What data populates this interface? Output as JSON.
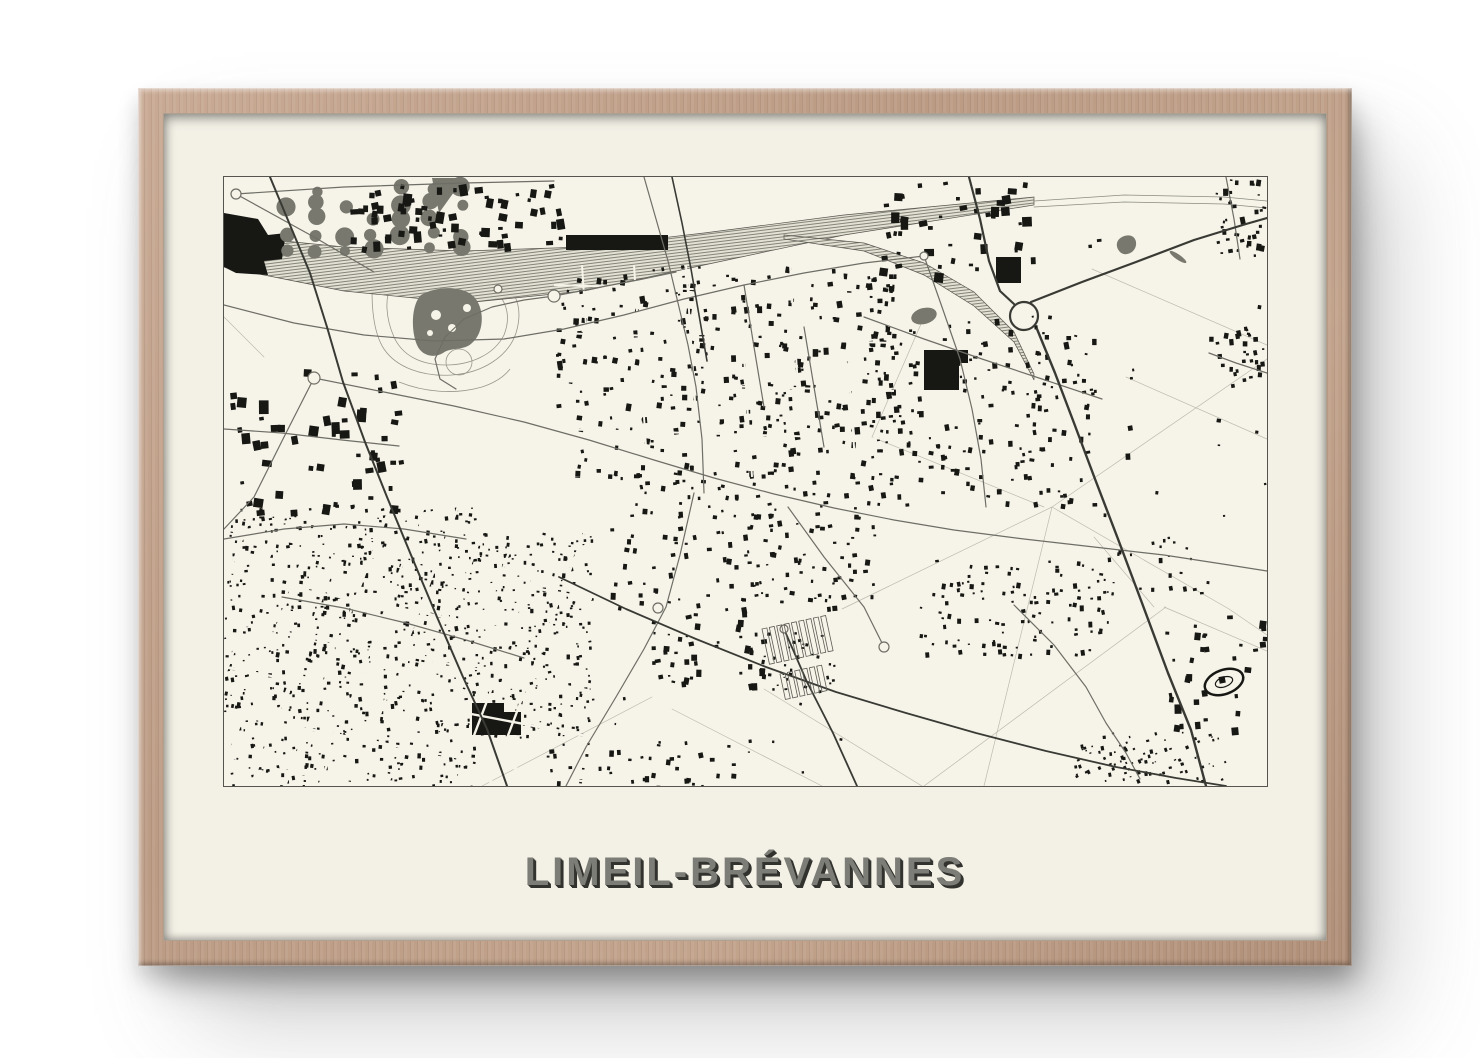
{
  "poster": {
    "title": "LIMEIL-BRÉVANNES"
  },
  "colors": {
    "page_bg": "#ffffff",
    "frame_wood": "#bb9b84",
    "mat": "#f3f1e6",
    "map_paper": "#f6f4e9",
    "map_border": "#55544e",
    "ink": "#171714",
    "gray_fill": "#78786f",
    "road": "#6e6e66",
    "road_dark": "#3a3a35",
    "faint_line": "#bcbaae",
    "outline": "#97968c",
    "title_face": "#7d7d77",
    "title_shadow": "#32322e"
  },
  "map": {
    "width": 1043,
    "height": 609,
    "orchard": {
      "x0": 62,
      "y0": 12,
      "cols": 7,
      "rows": 5,
      "dx": 29,
      "dy": 15,
      "jitter": 3,
      "rmin": 5,
      "rmax": 10,
      "skip": 0.18
    },
    "railways": [
      {
        "pts": [
          [
            0,
            74
          ],
          [
            120,
            92
          ],
          [
            240,
            100
          ],
          [
            360,
            92
          ],
          [
            480,
            72
          ],
          [
            620,
            48
          ],
          [
            810,
            24
          ]
        ],
        "half": [
          16,
          22,
          26,
          22,
          16,
          10,
          4
        ]
      },
      {
        "pts": [
          [
            560,
            60
          ],
          [
            640,
            70
          ],
          [
            700,
            92
          ],
          [
            750,
            122
          ],
          [
            790,
            160
          ],
          [
            810,
            200
          ]
        ],
        "half": [
          2,
          4,
          6,
          7,
          5,
          3
        ]
      }
    ],
    "rail_lines": [
      [
        [
          810,
          24
        ],
        [
          900,
          18
        ],
        [
          1000,
          20
        ],
        [
          1043,
          24
        ]
      ],
      [
        [
          810,
          30
        ],
        [
          900,
          25
        ],
        [
          1000,
          27
        ],
        [
          1043,
          31
        ]
      ]
    ],
    "outline_paths": [
      "M150,95 C180,88 230,86 262,96 C292,106 300,130 292,156 C284,180 258,196 228,198 C198,200 172,190 160,172 C148,154 146,118 150,95",
      "M168,108 C192,100 238,98 262,108 C282,118 288,138 280,158 C270,178 246,188 222,188 C196,188 178,178 170,160 C162,142 160,120 168,108",
      "M175,205 C200,215 230,218 258,210 C270,206 280,200 286,192"
    ],
    "outline_circles": [
      [
        235,
        185,
        13
      ]
    ],
    "gray_paths": [
      "M197,118 c18,-10 44,-9 54,3 c10,12 9,35 -3,45 c-8,8 -21,4 -29,10 c-10,6 -22,2 -26,-8 c-6,-14 -6,-40 4,-50 z",
      "M208,1 L240,1 L215,36 Z",
      "M898,60 c8,-4 15,0 14,8 c-1,8 -11,12 -16,7 c-5,-5 -4,-12 2,-15 z"
    ],
    "gray_ellipses": [
      {
        "cx": 700,
        "cy": 139,
        "rx": 13,
        "ry": 8,
        "rot": -15
      },
      {
        "cx": 954,
        "cy": 80,
        "rx": 10,
        "ry": 2.6,
        "rot": 35
      }
    ],
    "lake_holes": [
      [
        212,
        138,
        5
      ],
      [
        228,
        151,
        4
      ],
      [
        243,
        131,
        4
      ],
      [
        206,
        156,
        3
      ]
    ],
    "black_paths": [
      "M0,36 L34,42 L44,58 L62,56 L58,82 L40,84 L44,98 L12,96 L0,90 Z",
      "M342,58 h102 v15 h-102 z",
      "M700,173 h44 v13 h-9 v27 h-35 z",
      "M248,526 h32 v9 h17 v23 h-49 z",
      "M772,80 h25 v26 h-25 z"
    ],
    "clusters": [
      {
        "x": 125,
        "y": 6,
        "w": 210,
        "h": 64,
        "n": 70,
        "s0": 3,
        "s1": 9
      },
      {
        "x": 655,
        "y": 4,
        "w": 155,
        "h": 98,
        "n": 48,
        "s0": 3,
        "s1": 10
      },
      {
        "x": 990,
        "y": 2,
        "w": 50,
        "h": 80,
        "n": 36,
        "s0": 2,
        "s1": 5
      },
      {
        "x": 330,
        "y": 88,
        "w": 340,
        "h": 210,
        "n": 330,
        "s0": 2,
        "s1": 5.5
      },
      {
        "x": 645,
        "y": 138,
        "w": 225,
        "h": 190,
        "n": 190,
        "s0": 2,
        "s1": 5
      },
      {
        "x": 985,
        "y": 148,
        "w": 56,
        "h": 62,
        "n": 30,
        "s0": 2,
        "s1": 5
      },
      {
        "x": 0,
        "y": 192,
        "w": 175,
        "h": 142,
        "n": 55,
        "s0": 3.5,
        "s1": 10
      },
      {
        "x": 380,
        "y": 298,
        "w": 270,
        "h": 132,
        "n": 165,
        "s0": 2,
        "s1": 5
      },
      {
        "x": 695,
        "y": 383,
        "w": 195,
        "h": 96,
        "n": 115,
        "s0": 1.8,
        "s1": 4.2
      },
      {
        "x": 0,
        "y": 330,
        "w": 250,
        "h": 279,
        "n": 640,
        "s0": 1.4,
        "s1": 3.6
      },
      {
        "x": 250,
        "y": 355,
        "w": 118,
        "h": 205,
        "n": 255,
        "s0": 1.4,
        "s1": 3.4
      },
      {
        "x": 420,
        "y": 430,
        "w": 120,
        "h": 78,
        "n": 48,
        "s0": 2,
        "s1": 6
      },
      {
        "x": 540,
        "y": 452,
        "w": 72,
        "h": 62,
        "n": 30,
        "s0": 1.6,
        "s1": 3.5
      },
      {
        "x": 940,
        "y": 428,
        "w": 100,
        "h": 128,
        "n": 34,
        "s0": 2.5,
        "s1": 7
      },
      {
        "x": 848,
        "y": 552,
        "w": 152,
        "h": 52,
        "n": 92,
        "s0": 1.4,
        "s1": 3.2,
        "rot": -18
      },
      {
        "x": 850,
        "y": 60,
        "w": 190,
        "h": 300,
        "n": 16,
        "s0": 2,
        "s1": 5
      },
      {
        "x": 320,
        "y": 560,
        "w": 200,
        "h": 49,
        "n": 40,
        "s0": 2,
        "s1": 5
      },
      {
        "x": 870,
        "y": 360,
        "w": 120,
        "h": 60,
        "n": 25,
        "s0": 1.8,
        "s1": 4
      },
      {
        "x": 350,
        "y": 520,
        "w": 300,
        "h": 80,
        "n": 10,
        "s0": 1.5,
        "s1": 3.5
      }
    ],
    "carves": [
      {
        "clip": [
          0,
          330,
          368,
          279
        ],
        "lines": [
          {
            "from": [
              30,
              330
            ],
            "to": [
              -75,
              609
            ],
            "repeat": 11,
            "step": [
              34,
              0
            ]
          },
          {
            "from": [
              0,
              352
            ],
            "to": [
              368,
              422
            ],
            "repeat": 6,
            "step": [
              0,
              46
            ]
          }
        ],
        "width": 2.4
      },
      {
        "clip": [
          330,
          88,
          340,
          212
        ],
        "lines": [
          {
            "from": [
              358,
              88
            ],
            "to": [
              372,
              300
            ],
            "repeat": 7,
            "step": [
              52,
              0
            ]
          },
          {
            "from": [
              330,
              108
            ],
            "to": [
              670,
              118
            ],
            "repeat": 5,
            "step": [
              0,
              48
            ]
          }
        ],
        "width": 2
      }
    ],
    "faint_lines": [
      [
        [
          828,
          330
        ],
        [
          1043,
          182
        ]
      ],
      [
        [
          828,
          330
        ],
        [
          1005,
          432
        ]
      ],
      [
        [
          700,
          609
        ],
        [
          942,
          430
        ]
      ],
      [
        [
          868,
          92
        ],
        [
          1043,
          168
        ]
      ],
      [
        [
          902,
          200
        ],
        [
          1043,
          262
        ]
      ],
      [
        [
          828,
          330
        ],
        [
          760,
          609
        ]
      ],
      [
        [
          618,
          432
        ],
        [
          828,
          330
        ]
      ],
      [
        [
          940,
          430
        ],
        [
          1043,
          474
        ]
      ],
      [
        [
          540,
          512
        ],
        [
          698,
          609
        ]
      ],
      [
        [
          448,
          532
        ],
        [
          598,
          609
        ]
      ],
      [
        [
          258,
          609
        ],
        [
          428,
          520
        ]
      ],
      [
        [
          820,
          330
        ],
        [
          648,
          260
        ]
      ],
      [
        [
          648,
          260
        ],
        [
          700,
          140
        ]
      ],
      [
        [
          870,
          360
        ],
        [
          930,
          430
        ]
      ],
      [
        [
          1005,
          432
        ],
        [
          1043,
          458
        ]
      ],
      [
        [
          0,
          140
        ],
        [
          40,
          180
        ]
      ]
    ],
    "roads": [
      [
        [
          0,
          128
        ],
        [
          70,
          146
        ],
        [
          140,
          158
        ],
        [
          210,
          164
        ],
        [
          280,
          162
        ],
        [
          340,
          152
        ],
        [
          400,
          138
        ],
        [
          460,
          122
        ],
        [
          520,
          108
        ],
        [
          580,
          96
        ],
        [
          640,
          86
        ],
        [
          700,
          79
        ]
      ],
      [
        [
          420,
          0
        ],
        [
          432,
          42
        ],
        [
          444,
          84
        ],
        [
          454,
          126
        ],
        [
          464,
          168
        ],
        [
          472,
          210
        ],
        [
          478,
          262
        ],
        [
          480,
          316
        ]
      ],
      [
        [
          90,
          201
        ],
        [
          160,
          215
        ],
        [
          230,
          229
        ],
        [
          300,
          245
        ],
        [
          365,
          263
        ],
        [
          430,
          283
        ],
        [
          490,
          301
        ],
        [
          550,
          317
        ],
        [
          610,
          331
        ],
        [
          670,
          343
        ],
        [
          730,
          353
        ],
        [
          800,
          362
        ],
        [
          870,
          370
        ],
        [
          940,
          378
        ],
        [
          1005,
          388
        ],
        [
          1043,
          394
        ]
      ],
      [
        [
          470,
          316
        ],
        [
          456,
          378
        ],
        [
          442,
          430
        ],
        [
          420,
          472
        ],
        [
          392,
          520
        ],
        [
          362,
          570
        ],
        [
          342,
          609
        ]
      ],
      [
        [
          640,
          140
        ],
        [
          700,
          162
        ],
        [
          758,
          182
        ],
        [
          818,
          202
        ],
        [
          878,
          222
        ]
      ],
      [
        [
          700,
          79
        ],
        [
          718,
          130
        ],
        [
          736,
          182
        ],
        [
          748,
          232
        ],
        [
          757,
          282
        ],
        [
          762,
          330
        ]
      ],
      [
        [
          0,
          252
        ],
        [
          58,
          256
        ],
        [
          118,
          263
        ],
        [
          175,
          269
        ]
      ],
      [
        [
          0,
          362
        ],
        [
          60,
          352
        ],
        [
          120,
          347
        ],
        [
          180,
          352
        ],
        [
          242,
          362
        ]
      ],
      [
        [
          58,
          420
        ],
        [
          120,
          431
        ],
        [
          182,
          446
        ],
        [
          242,
          463
        ],
        [
          300,
          481
        ]
      ],
      [
        [
          330,
          119
        ],
        [
          300,
          123
        ],
        [
          268,
          130
        ],
        [
          240,
          142
        ],
        [
          221,
          160
        ],
        [
          211,
          182
        ],
        [
          216,
          202
        ],
        [
          232,
          212
        ]
      ],
      [
        [
          330,
          119
        ],
        [
          372,
          111
        ],
        [
          414,
          103
        ],
        [
          452,
          95
        ]
      ],
      [
        [
          985,
          176
        ],
        [
          1012,
          186
        ],
        [
          1043,
          196
        ]
      ],
      [
        [
          1002,
          0
        ],
        [
          1010,
          42
        ],
        [
          1016,
          82
        ]
      ],
      [
        [
          790,
          428
        ],
        [
          830,
          468
        ],
        [
          862,
          510
        ],
        [
          882,
          546
        ],
        [
          902,
          576
        ],
        [
          916,
          602
        ]
      ],
      [
        [
          12,
          17
        ],
        [
          90,
          60
        ],
        [
          150,
          95
        ]
      ],
      [
        [
          12,
          17
        ],
        [
          120,
          10
        ],
        [
          240,
          6
        ],
        [
          330,
          4
        ]
      ],
      [
        [
          90,
          201
        ],
        [
          60,
          260
        ],
        [
          30,
          320
        ],
        [
          0,
          352
        ]
      ],
      [
        [
          564,
          330
        ],
        [
          600,
          380
        ],
        [
          640,
          430
        ],
        [
          660,
          470
        ]
      ],
      [
        [
          520,
          108
        ],
        [
          530,
          170
        ],
        [
          540,
          230
        ]
      ],
      [
        [
          580,
          150
        ],
        [
          590,
          210
        ],
        [
          600,
          270
        ]
      ]
    ],
    "dark_roads": [
      {
        "pts": [
          [
            745,
            0
          ],
          [
            756,
            42
          ],
          [
            765,
            84
          ],
          [
            776,
            114
          ],
          [
            790,
            127
          ]
        ],
        "w": 2.2
      },
      {
        "pts": [
          [
            813,
            152
          ],
          [
            831,
            196
          ],
          [
            850,
            246
          ],
          [
            871,
            302
          ],
          [
            894,
            362
          ],
          [
            918,
            426
          ],
          [
            944,
            496
          ],
          [
            967,
            553
          ],
          [
            982,
            609
          ]
        ],
        "w": 2.4
      },
      {
        "pts": [
          [
            807,
            125
          ],
          [
            858,
            105
          ],
          [
            912,
            85
          ],
          [
            970,
            63
          ],
          [
            1022,
            47
          ],
          [
            1043,
            41
          ]
        ],
        "w": 2.2
      },
      {
        "pts": [
          [
            46,
            0
          ],
          [
            66,
            48
          ],
          [
            86,
            96
          ],
          [
            103,
            150
          ],
          [
            119,
            205
          ],
          [
            141,
            265
          ],
          [
            163,
            320
          ],
          [
            187,
            378
          ],
          [
            213,
            440
          ],
          [
            239,
            500
          ],
          [
            263,
            552
          ],
          [
            283,
            609
          ]
        ],
        "w": 2
      },
      {
        "pts": [
          [
            335,
            400
          ],
          [
            402,
            432
          ],
          [
            472,
            462
          ],
          [
            542,
            490
          ],
          [
            612,
            515
          ],
          [
            682,
            536
          ],
          [
            752,
            556
          ],
          [
            822,
            574
          ],
          [
            892,
            590
          ],
          [
            952,
            601
          ],
          [
            1002,
            609
          ]
        ],
        "w": 1.8
      },
      {
        "pts": [
          [
            560,
            452
          ],
          [
            583,
            505
          ],
          [
            609,
            556
          ],
          [
            633,
            609
          ]
        ],
        "w": 1.8
      },
      {
        "pts": [
          [
            448,
            0
          ],
          [
            458,
            46
          ],
          [
            467,
            92
          ],
          [
            475,
            138
          ],
          [
            483,
            184
          ]
        ],
        "w": 1.6
      }
    ],
    "roundabouts": [
      [
        12,
        17,
        5
      ],
      [
        90,
        201,
        6
      ],
      [
        330,
        119,
        6
      ],
      [
        274,
        112,
        4
      ],
      [
        434,
        431,
        5
      ],
      [
        560,
        452,
        4
      ],
      [
        660,
        470,
        5
      ],
      [
        700,
        79,
        4
      ]
    ],
    "highway_loop": {
      "cx": 800,
      "cy": 139,
      "r": 14
    },
    "allotments": [
      {
        "x": 538,
        "y": 452,
        "cols": 9,
        "w": 5,
        "h": 36,
        "gap": 7.5,
        "rot": -12
      },
      {
        "x": 556,
        "y": 497,
        "cols": 6,
        "w": 5,
        "h": 26,
        "gap": 7.5,
        "rot": -12
      }
    ],
    "stadium": {
      "cx": 1000,
      "cy": 505,
      "rx": 20,
      "ry": 12,
      "rot": -20
    }
  }
}
